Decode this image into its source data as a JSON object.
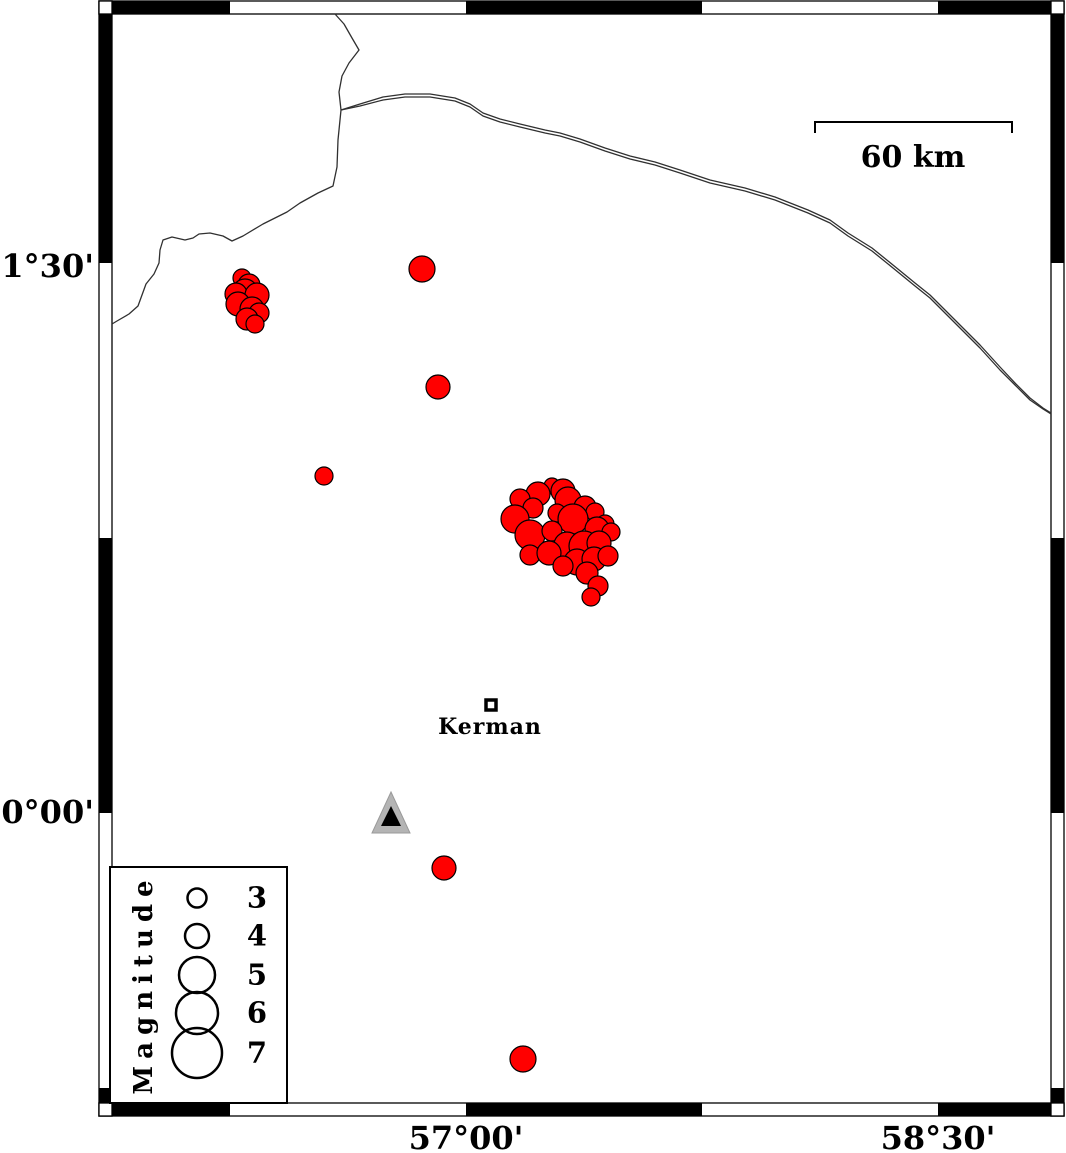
{
  "figure": {
    "width": 1066,
    "height": 1153,
    "bg": "#ffffff",
    "title": "Seismicity map of the Kerman region"
  },
  "frame": {
    "outer": {
      "x0": 99,
      "y0": 1,
      "x1": 1064,
      "y1": 1116
    },
    "thickness": 13,
    "x_black_segments": [
      [
        112,
        230
      ],
      [
        466,
        702
      ],
      [
        938,
        1051
      ]
    ],
    "y_black_segments": [
      [
        14,
        263
      ],
      [
        538,
        813
      ],
      [
        1088,
        1103
      ]
    ],
    "black": "#000000",
    "white": "#ffffff"
  },
  "axis_labels": {
    "left": [
      {
        "text": "31°30'",
        "y": 267
      },
      {
        "text": "30°00'",
        "y": 813
      }
    ],
    "bottom": [
      {
        "text": "57°00'",
        "x": 466
      },
      {
        "text": "58°30'",
        "x": 938
      }
    ]
  },
  "scale_bar": {
    "x1": 815,
    "x2": 1012,
    "y": 122,
    "tick_len": 11,
    "label": "60 km"
  },
  "city": {
    "name": "Kerman",
    "x": 491,
    "y": 705,
    "half": 5,
    "stroke_w": 3.5
  },
  "station": {
    "outer": [
      [
        391,
        792
      ],
      [
        372,
        833
      ],
      [
        410,
        833
      ]
    ],
    "inner": [
      [
        391,
        806
      ],
      [
        381,
        826
      ],
      [
        401,
        826
      ]
    ],
    "outer_fill": "#b4b4b4",
    "inner_fill": "#000000"
  },
  "lines": {
    "color": "#303030",
    "width": 1.3,
    "border": [
      [
        335,
        14
      ],
      [
        344,
        24
      ],
      [
        352,
        38
      ],
      [
        359,
        50
      ],
      [
        349,
        63
      ],
      [
        342,
        76
      ],
      [
        339,
        92
      ],
      [
        341,
        110
      ],
      [
        338,
        140
      ],
      [
        337,
        167
      ],
      [
        333,
        186
      ],
      [
        318,
        193
      ],
      [
        300,
        203
      ],
      [
        287,
        212
      ],
      [
        263,
        224
      ],
      [
        243,
        236
      ],
      [
        232,
        241
      ],
      [
        223,
        236
      ],
      [
        210,
        233
      ],
      [
        199,
        234
      ],
      [
        193,
        238
      ],
      [
        185,
        240
      ],
      [
        172,
        237
      ],
      [
        163,
        240
      ],
      [
        160,
        250
      ],
      [
        159,
        263
      ],
      [
        154,
        274
      ],
      [
        146,
        284
      ],
      [
        142,
        295
      ],
      [
        138,
        306
      ],
      [
        129,
        314
      ],
      [
        117,
        321
      ],
      [
        112,
        324
      ]
    ],
    "road_upper": [
      [
        341,
        110
      ],
      [
        360,
        104
      ],
      [
        383,
        97
      ],
      [
        405,
        94
      ],
      [
        430,
        94
      ],
      [
        455,
        98
      ],
      [
        470,
        104
      ],
      [
        483,
        113
      ],
      [
        500,
        119
      ],
      [
        520,
        124
      ],
      [
        545,
        130
      ],
      [
        560,
        133
      ],
      [
        580,
        139
      ],
      [
        605,
        148
      ],
      [
        630,
        156
      ],
      [
        655,
        162
      ],
      [
        680,
        170
      ],
      [
        710,
        180
      ],
      [
        745,
        188
      ],
      [
        775,
        197
      ],
      [
        808,
        210
      ],
      [
        830,
        220
      ],
      [
        848,
        233
      ],
      [
        872,
        248
      ],
      [
        893,
        265
      ],
      [
        915,
        283
      ],
      [
        930,
        295
      ],
      [
        950,
        315
      ],
      [
        968,
        333
      ],
      [
        980,
        345
      ],
      [
        1000,
        367
      ],
      [
        1015,
        383
      ],
      [
        1030,
        398
      ],
      [
        1043,
        408
      ],
      [
        1051,
        413
      ]
    ],
    "road_lower": [
      [
        341,
        110
      ],
      [
        360,
        106
      ],
      [
        383,
        100
      ],
      [
        405,
        97
      ],
      [
        430,
        97
      ],
      [
        455,
        101
      ],
      [
        470,
        107
      ],
      [
        483,
        116
      ],
      [
        500,
        122
      ],
      [
        520,
        127
      ],
      [
        545,
        133
      ],
      [
        560,
        136
      ],
      [
        580,
        142
      ],
      [
        605,
        151
      ],
      [
        630,
        159
      ],
      [
        655,
        165
      ],
      [
        680,
        173
      ],
      [
        710,
        183
      ],
      [
        745,
        191
      ],
      [
        775,
        200
      ],
      [
        808,
        213
      ],
      [
        830,
        223
      ],
      [
        848,
        236
      ],
      [
        872,
        251
      ],
      [
        893,
        268
      ],
      [
        915,
        286
      ],
      [
        930,
        298
      ],
      [
        950,
        318
      ],
      [
        968,
        336
      ],
      [
        980,
        348
      ],
      [
        1000,
        370
      ],
      [
        1015,
        385
      ],
      [
        1030,
        400
      ],
      [
        1043,
        409
      ],
      [
        1051,
        414
      ]
    ]
  },
  "chart_data": {
    "type": "scatter",
    "description": "Earthquake epicenters (red circles scaled by magnitude), points are [x_px, y_px, radius_px]",
    "x_axis": {
      "tick_labels": [
        "57°00'",
        "58°30'"
      ],
      "tick_px": [
        466,
        938
      ]
    },
    "y_axis": {
      "tick_labels": [
        "31°30'",
        "30°00'"
      ],
      "tick_px": [
        263,
        813
      ]
    },
    "scale_bar_km": 60,
    "earthquakes": {
      "fill": "#ff0000",
      "stroke": "#000000",
      "points": [
        [
          422,
          269,
          13
        ],
        [
          438,
          387,
          12
        ],
        [
          324,
          476,
          9
        ],
        [
          444,
          868,
          12
        ],
        [
          523,
          1059,
          13
        ],
        [
          242,
          278,
          9
        ],
        [
          249,
          285,
          11
        ],
        [
          245,
          292,
          13
        ],
        [
          236,
          294,
          11
        ],
        [
          257,
          295,
          12
        ],
        [
          238,
          304,
          12
        ],
        [
          252,
          309,
          12
        ],
        [
          259,
          313,
          10
        ],
        [
          247,
          319,
          11
        ],
        [
          255,
          324,
          9
        ],
        [
          552,
          486,
          8
        ],
        [
          563,
          491,
          12
        ],
        [
          538,
          494,
          12
        ],
        [
          520,
          499,
          10
        ],
        [
          568,
          500,
          13
        ],
        [
          585,
          507,
          11
        ],
        [
          533,
          508,
          10
        ],
        [
          515,
          519,
          14
        ],
        [
          557,
          513,
          9
        ],
        [
          595,
          512,
          9
        ],
        [
          573,
          519,
          15
        ],
        [
          605,
          524,
          9
        ],
        [
          530,
          535,
          15
        ],
        [
          552,
          531,
          10
        ],
        [
          597,
          529,
          12
        ],
        [
          611,
          532,
          9
        ],
        [
          567,
          545,
          13
        ],
        [
          584,
          546,
          15
        ],
        [
          599,
          543,
          12
        ],
        [
          530,
          555,
          10
        ],
        [
          549,
          553,
          12
        ],
        [
          577,
          562,
          13
        ],
        [
          594,
          559,
          12
        ],
        [
          608,
          556,
          10
        ],
        [
          563,
          566,
          10
        ],
        [
          587,
          573,
          11
        ],
        [
          598,
          586,
          10
        ],
        [
          591,
          597,
          9
        ]
      ]
    }
  },
  "legend": {
    "title": "Magnitude",
    "box": {
      "x": 110,
      "y": 867,
      "w": 177,
      "h": 236
    },
    "circle_x": 197,
    "stroke_w": 2.5,
    "entries": [
      {
        "label": "3",
        "cy": 898,
        "r": 9.5
      },
      {
        "label": "4",
        "cy": 936,
        "r": 12
      },
      {
        "label": "5",
        "cy": 975,
        "r": 18
      },
      {
        "label": "6",
        "cy": 1013,
        "r": 21
      },
      {
        "label": "7",
        "cy": 1053,
        "r": 25
      }
    ]
  }
}
